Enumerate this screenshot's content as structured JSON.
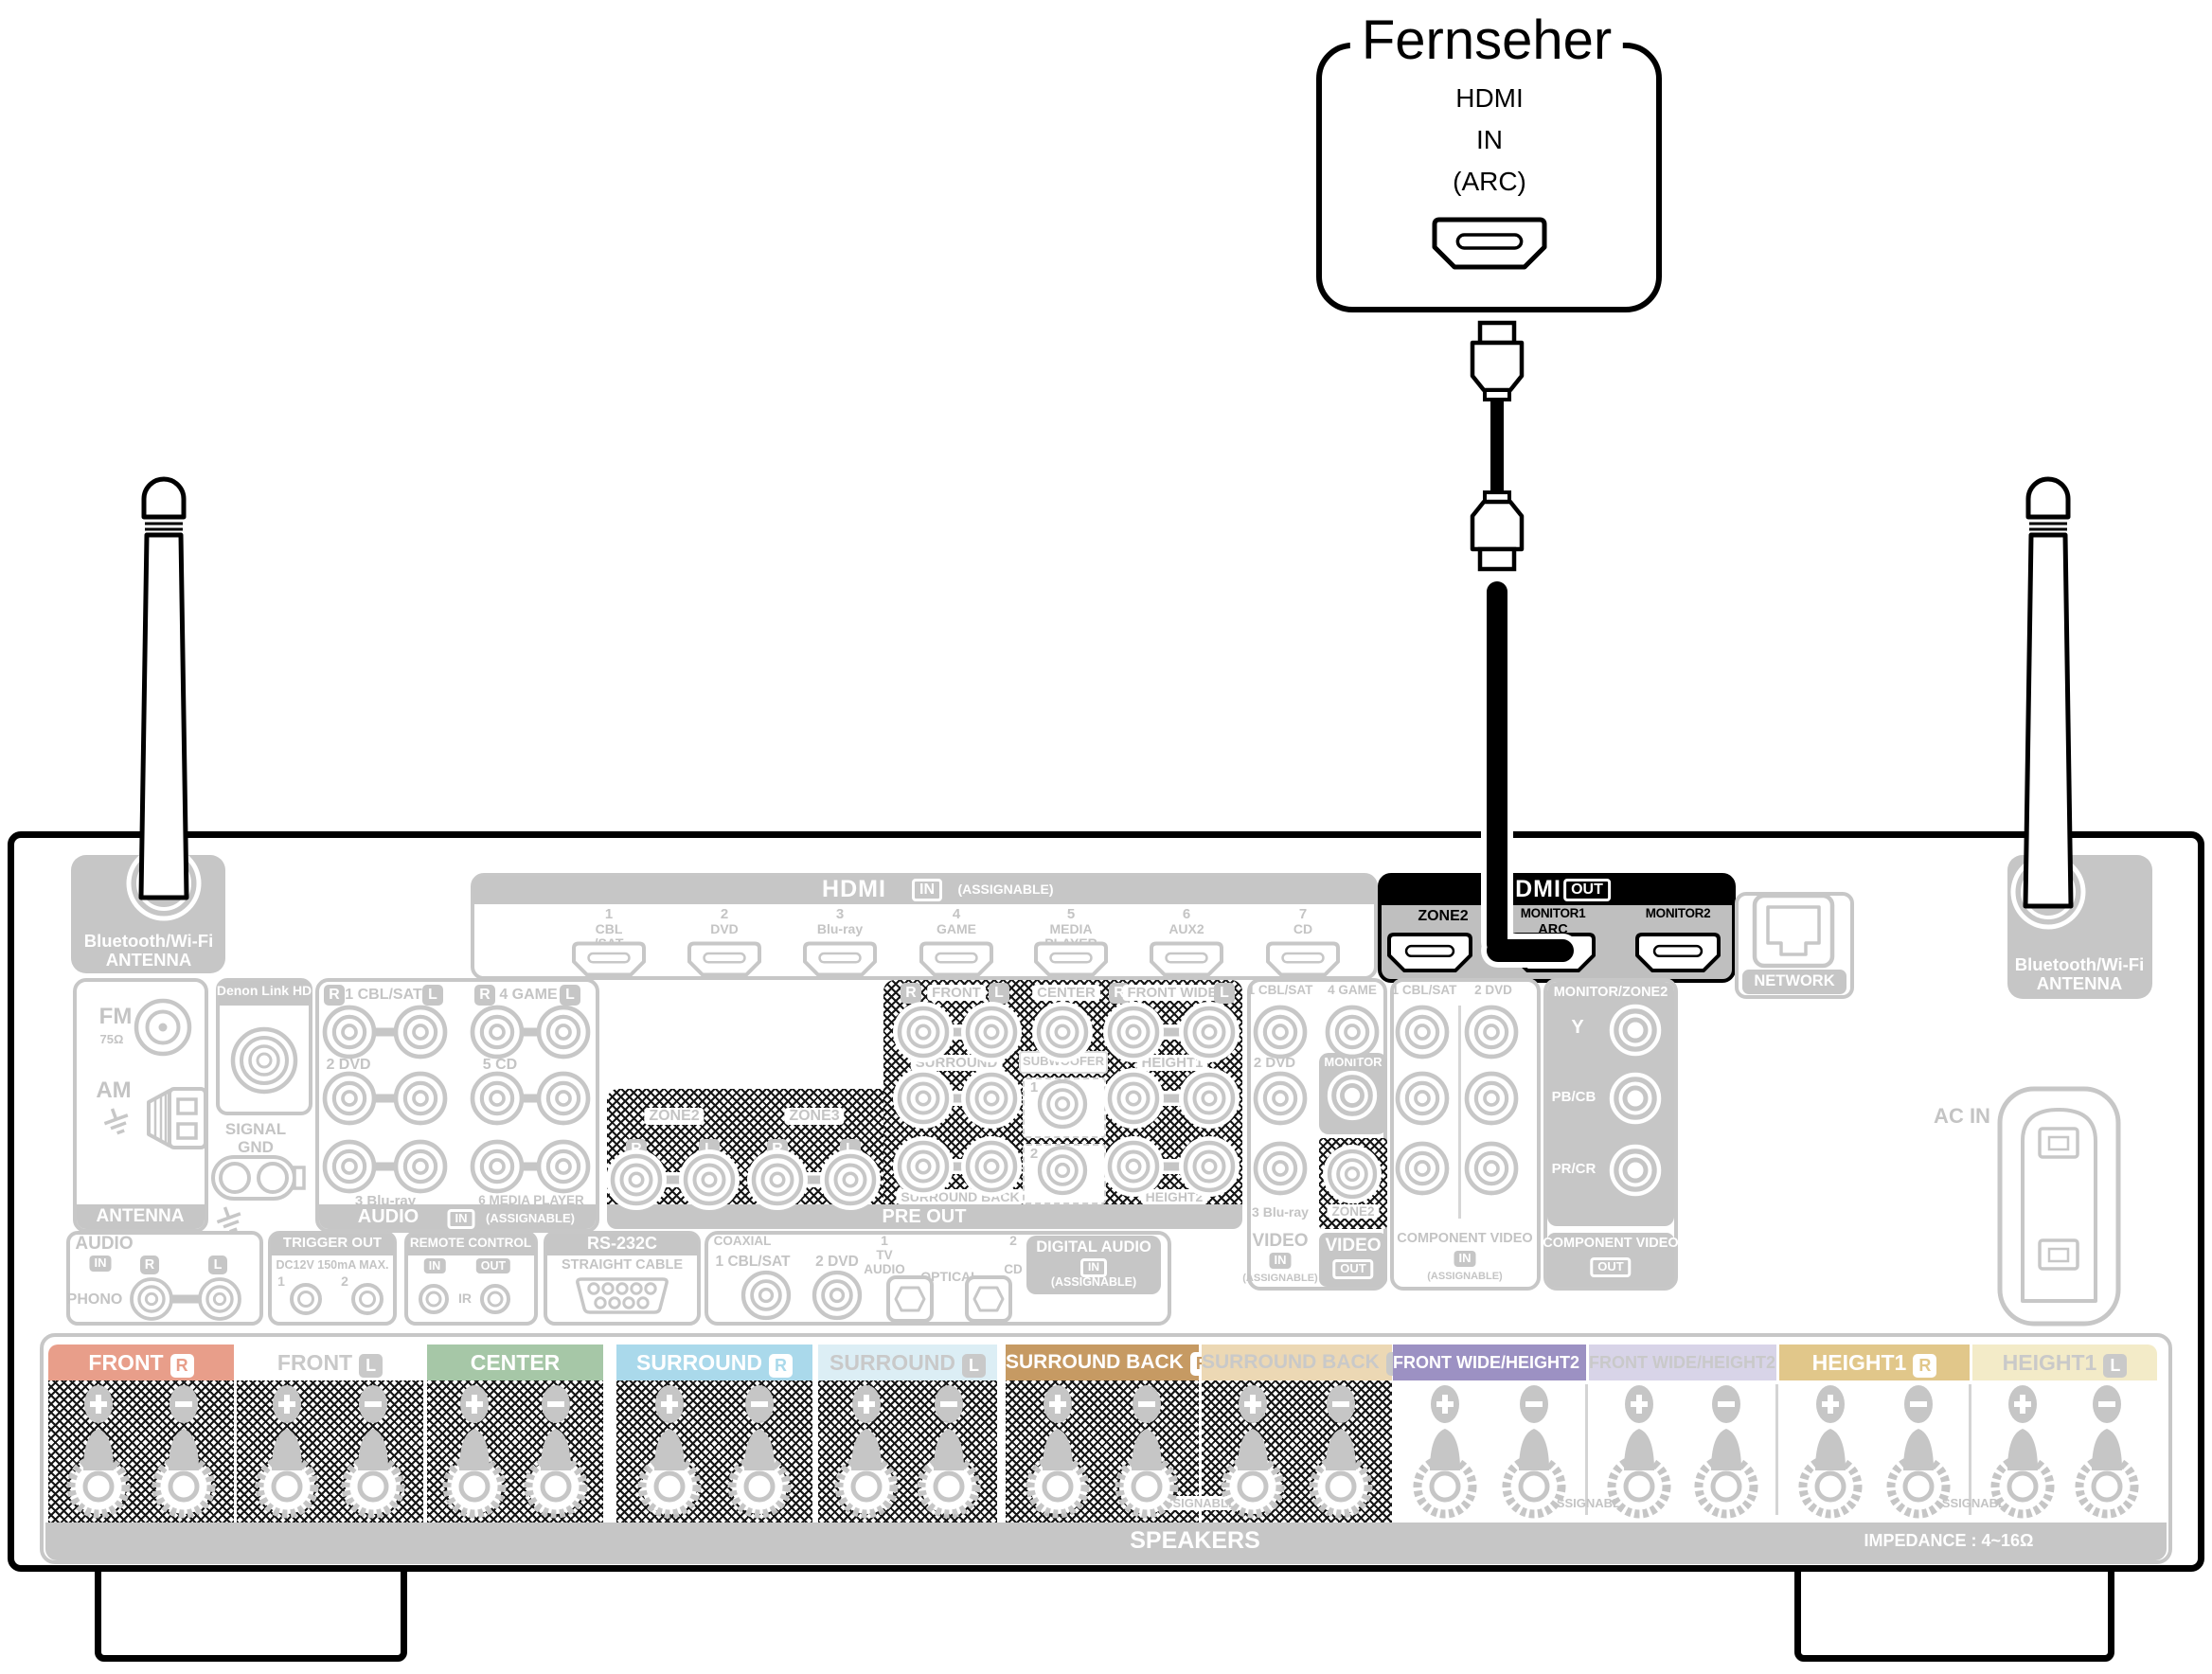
{
  "colors": {
    "disabled_gray": "#c6c6c6",
    "disabled_text": "#c4c4c4",
    "highlight_black": "#000000",
    "hdmi_out_body": "#bfbfbf",
    "speaker_labels": {
      "front_r": "#e89e8a",
      "front_l": "#ffffff",
      "center": "#a6c7a7",
      "surround_r": "#aad9eb",
      "surround_l": "#dceef5",
      "surround_back_r": "#c69a63",
      "surround_back_l": "#ecd8b4",
      "front_wide_r": "#9c91c3",
      "front_wide_l": "#d8d4e8",
      "height1_r": "#e1c78a",
      "height1_l": "#f3ebc8"
    }
  },
  "tv": {
    "title": "Fernseher",
    "port": {
      "line1": "HDMI",
      "line2": "IN",
      "line3": "(ARC)"
    }
  },
  "hdmi_in": {
    "title": "HDMI",
    "badge": "IN",
    "note": "(ASSIGNABLE)",
    "ports": [
      {
        "num": "1",
        "name": [
          "CBL",
          "/SAT"
        ]
      },
      {
        "num": "2",
        "name": [
          "DVD"
        ]
      },
      {
        "num": "3",
        "name": [
          "Blu-ray"
        ]
      },
      {
        "num": "4",
        "name": [
          "GAME"
        ]
      },
      {
        "num": "5",
        "name": [
          "MEDIA",
          "PLAYER"
        ]
      },
      {
        "num": "6",
        "name": [
          "AUX2"
        ]
      },
      {
        "num": "7",
        "name": [
          "CD"
        ]
      }
    ]
  },
  "hdmi_out": {
    "title": "HDMI",
    "badge": "OUT",
    "ports": [
      {
        "label": "ZONE2"
      },
      {
        "label": "MONITOR1",
        "sub": "ARC"
      },
      {
        "label": "MONITOR2"
      }
    ]
  },
  "bluetooth_left": {
    "line1": "Bluetooth/Wi-Fi",
    "line2": "ANTENNA"
  },
  "bluetooth_right": {
    "line1": "Bluetooth/Wi-Fi",
    "line2": "ANTENNA"
  },
  "network": {
    "label": "NETWORK"
  },
  "tuner": {
    "fm": "FM",
    "fm_ohm": "75Ω",
    "am": "AM",
    "footer": "ANTENNA"
  },
  "denon_link": {
    "title": "Denon Link HD",
    "signal_gnd": [
      "SIGNAL",
      "GND"
    ]
  },
  "audio_in": {
    "title": "AUDIO",
    "badge": "IN",
    "note": "(ASSIGNABLE)",
    "r": "R",
    "l": "L",
    "labels": {
      "p1": "1 CBL/SAT",
      "p2": "2 DVD",
      "p3": "3 Blu-ray",
      "p4": "4 GAME",
      "p5": "5 CD",
      "p6": "6 MEDIA PLAYER"
    }
  },
  "pre_out": {
    "footer": "PRE OUT",
    "r": "R",
    "l": "L",
    "row1": {
      "front": "FRONT",
      "center": "CENTER",
      "front_wide": "FRONT WIDE"
    },
    "row2": {
      "surround": "SURROUND",
      "subwoofer": "SUBWOOFER",
      "height1": "HEIGHT1"
    },
    "row3": {
      "surround_back": "SURROUND BACK",
      "height2": "HEIGHT2"
    },
    "sub_nums": [
      "1",
      "2"
    ],
    "zones": {
      "zone2": "ZONE2",
      "zone3": "ZONE3"
    }
  },
  "phono": {
    "title": "AUDIO",
    "badge": "IN",
    "r": "R",
    "l": "L",
    "label": "PHONO"
  },
  "trigger_out": {
    "title": "TRIGGER OUT",
    "sub": "DC12V 150mA MAX.",
    "jacks": [
      "1",
      "2"
    ]
  },
  "remote_control": {
    "title": "REMOTE CONTROL",
    "badge_in": "IN",
    "badge_out": "OUT",
    "ir": "IR"
  },
  "rs232c": {
    "title": "RS-232C",
    "sub": "STRAIGHT CABLE"
  },
  "digital_audio": {
    "coaxial": "COAXIAL",
    "coax1": "1 CBL/SAT",
    "coax2": "2 DVD",
    "opt1": [
      "1",
      "TV",
      "AUDIO"
    ],
    "optical": "OPTICAL",
    "opt2": [
      "2",
      "CD"
    ],
    "title": "DIGITAL AUDIO",
    "badge": "IN",
    "note": "(ASSIGNABLE)"
  },
  "video": {
    "in1": "1 CBL/SAT",
    "in4": "4 GAME",
    "in2": "2 DVD",
    "in3": "3 Blu-ray",
    "monitor": "MONITOR",
    "zone2": "ZONE2",
    "footer_in": {
      "title": "VIDEO",
      "badge": "IN",
      "note": "(ASSIGNABLE)"
    },
    "footer_out": {
      "title": "VIDEO",
      "badge": "OUT"
    }
  },
  "component_in": {
    "col1": "1 CBL/SAT",
    "col2": "2 DVD",
    "footer": {
      "title": "COMPONENT VIDEO",
      "badge": "IN",
      "note": "(ASSIGNABLE)"
    }
  },
  "component_out": {
    "header": "MONITOR/ZONE2",
    "rows": [
      "Y",
      "PB/CB",
      "PR/CR"
    ],
    "footer": {
      "title": "COMPONENT VIDEO",
      "badge": "OUT"
    }
  },
  "ac": {
    "label": "AC IN"
  },
  "speakers": {
    "groups": [
      {
        "label": "FRONT",
        "badge": "R",
        "colorKey": "front_r",
        "hatched": true,
        "textWhite": true
      },
      {
        "label": "FRONT",
        "badge": "L",
        "colorKey": "front_l",
        "hatched": true
      },
      {
        "label": "CENTER",
        "colorKey": "center",
        "hatched": true,
        "textWhite": true
      },
      {
        "label": "SURROUND",
        "badge": "R",
        "colorKey": "surround_r",
        "hatched": true,
        "textWhite": true
      },
      {
        "label": "SURROUND",
        "badge": "L",
        "colorKey": "surround_l",
        "hatched": true
      },
      {
        "label": "SURROUND BACK",
        "badge": "R",
        "colorKey": "surround_back_r",
        "hatched": true,
        "textWhite": true
      },
      {
        "label": "SURROUND BACK",
        "badge": "L",
        "colorKey": "surround_back_l",
        "hatched": true
      },
      {
        "label": "FRONT WIDE/HEIGHT2",
        "badge": "R",
        "colorKey": "front_wide_r",
        "textWhite": true
      },
      {
        "label": "FRONT WIDE/HEIGHT2",
        "badge": "L",
        "colorKey": "front_wide_l"
      },
      {
        "label": "HEIGHT1",
        "badge": "R",
        "colorKey": "height1_r",
        "textWhite": true
      },
      {
        "label": "HEIGHT1",
        "badge": "L",
        "colorKey": "height1_l"
      }
    ],
    "assignable": "ASSIGNABLE",
    "footer": "SPEAKERS",
    "impedance": "IMPEDANCE : 4~16Ω"
  }
}
